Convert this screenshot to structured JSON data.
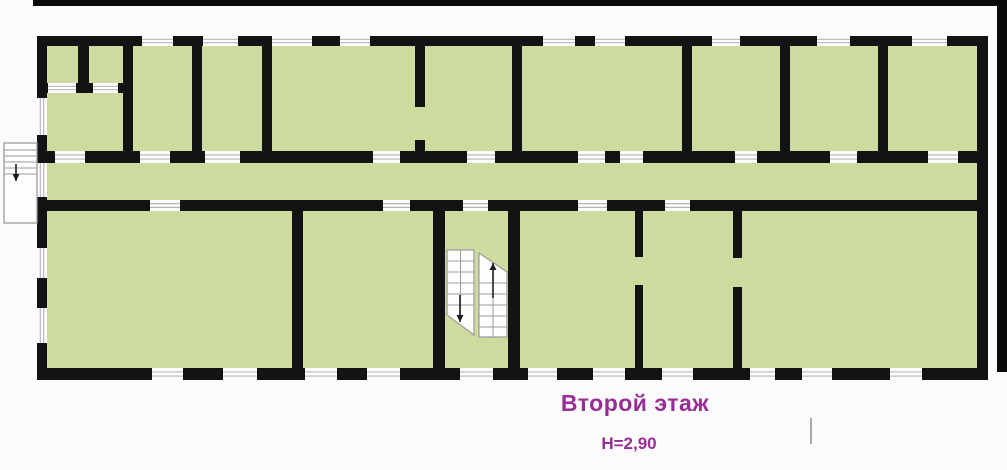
{
  "labels": {
    "floor": "Второй этаж",
    "height": "H=2,90"
  },
  "colors": {
    "page_bg": "#fbfbfb",
    "room_fill": "#cedb9e",
    "wall": "#131313",
    "opening_fill": "#fdfdfd",
    "opening_line": "#b6b6b6",
    "stair_fill": "#fdfdfd",
    "stair_line": "#9b9b9b",
    "arrow": "#1c1c1c",
    "label_text": "#962e96",
    "frame_bar": "#0a0a0a",
    "tick": "#a9a9a9"
  },
  "plan": {
    "canvas": {
      "w": 1007,
      "h": 470
    },
    "building": {
      "x": 37,
      "y": 36,
      "w": 951,
      "h": 344
    },
    "walls": [
      {
        "x": 37,
        "y": 36,
        "w": 951,
        "h": 10
      },
      {
        "x": 37,
        "y": 151,
        "w": 951,
        "h": 12
      },
      {
        "x": 37,
        "y": 200,
        "w": 951,
        "h": 11
      },
      {
        "x": 37,
        "y": 368,
        "w": 951,
        "h": 12
      },
      {
        "x": 37,
        "y": 36,
        "w": 10,
        "h": 344
      },
      {
        "x": 977,
        "y": 36,
        "w": 11,
        "h": 344
      },
      {
        "x": 37,
        "y": 83,
        "w": 96,
        "h": 10
      },
      {
        "x": 78,
        "y": 36,
        "w": 11,
        "h": 57
      },
      {
        "x": 123,
        "y": 36,
        "w": 10,
        "h": 127
      },
      {
        "x": 192,
        "y": 36,
        "w": 10,
        "h": 127
      },
      {
        "x": 262,
        "y": 36,
        "w": 10,
        "h": 127
      },
      {
        "x": 415,
        "y": 36,
        "w": 10,
        "h": 71
      },
      {
        "x": 415,
        "y": 140,
        "w": 10,
        "h": 23
      },
      {
        "x": 512,
        "y": 36,
        "w": 10,
        "h": 127
      },
      {
        "x": 682,
        "y": 36,
        "w": 10,
        "h": 127
      },
      {
        "x": 780,
        "y": 36,
        "w": 10,
        "h": 127
      },
      {
        "x": 878,
        "y": 36,
        "w": 10,
        "h": 127
      },
      {
        "x": 292,
        "y": 200,
        "w": 11,
        "h": 180
      },
      {
        "x": 433,
        "y": 200,
        "w": 12,
        "h": 180
      },
      {
        "x": 508,
        "y": 200,
        "w": 12,
        "h": 180
      },
      {
        "x": 635,
        "y": 200,
        "w": 8,
        "h": 57
      },
      {
        "x": 635,
        "y": 285,
        "w": 8,
        "h": 95
      },
      {
        "x": 733,
        "y": 200,
        "w": 9,
        "h": 58
      },
      {
        "x": 733,
        "y": 287,
        "w": 9,
        "h": 93
      }
    ],
    "openings": [
      {
        "x": 142,
        "y": 36,
        "w": 31,
        "h": 10,
        "dir": "h",
        "kind": "window"
      },
      {
        "x": 203,
        "y": 36,
        "w": 35,
        "h": 10,
        "dir": "h",
        "kind": "window"
      },
      {
        "x": 272,
        "y": 36,
        "w": 40,
        "h": 10,
        "dir": "h",
        "kind": "window"
      },
      {
        "x": 340,
        "y": 36,
        "w": 30,
        "h": 10,
        "dir": "h",
        "kind": "window"
      },
      {
        "x": 543,
        "y": 36,
        "w": 32,
        "h": 10,
        "dir": "h",
        "kind": "window"
      },
      {
        "x": 595,
        "y": 36,
        "w": 30,
        "h": 10,
        "dir": "h",
        "kind": "window"
      },
      {
        "x": 712,
        "y": 36,
        "w": 28,
        "h": 10,
        "dir": "h",
        "kind": "window"
      },
      {
        "x": 817,
        "y": 36,
        "w": 33,
        "h": 10,
        "dir": "h",
        "kind": "window"
      },
      {
        "x": 912,
        "y": 36,
        "w": 35,
        "h": 10,
        "dir": "h",
        "kind": "window"
      },
      {
        "x": 55,
        "y": 151,
        "w": 30,
        "h": 12,
        "dir": "h",
        "kind": "door"
      },
      {
        "x": 140,
        "y": 151,
        "w": 30,
        "h": 12,
        "dir": "h",
        "kind": "door"
      },
      {
        "x": 205,
        "y": 151,
        "w": 35,
        "h": 12,
        "dir": "h",
        "kind": "door"
      },
      {
        "x": 373,
        "y": 151,
        "w": 27,
        "h": 12,
        "dir": "h",
        "kind": "door"
      },
      {
        "x": 467,
        "y": 151,
        "w": 28,
        "h": 12,
        "dir": "h",
        "kind": "door"
      },
      {
        "x": 578,
        "y": 151,
        "w": 27,
        "h": 12,
        "dir": "h",
        "kind": "door"
      },
      {
        "x": 620,
        "y": 151,
        "w": 23,
        "h": 12,
        "dir": "h",
        "kind": "door"
      },
      {
        "x": 735,
        "y": 151,
        "w": 22,
        "h": 12,
        "dir": "h",
        "kind": "door"
      },
      {
        "x": 830,
        "y": 151,
        "w": 27,
        "h": 12,
        "dir": "h",
        "kind": "door"
      },
      {
        "x": 928,
        "y": 151,
        "w": 30,
        "h": 12,
        "dir": "h",
        "kind": "door"
      },
      {
        "x": 150,
        "y": 200,
        "w": 30,
        "h": 11,
        "dir": "h",
        "kind": "door"
      },
      {
        "x": 383,
        "y": 200,
        "w": 27,
        "h": 11,
        "dir": "h",
        "kind": "door"
      },
      {
        "x": 463,
        "y": 200,
        "w": 25,
        "h": 11,
        "dir": "h",
        "kind": "door"
      },
      {
        "x": 578,
        "y": 200,
        "w": 29,
        "h": 11,
        "dir": "h",
        "kind": "door"
      },
      {
        "x": 665,
        "y": 200,
        "w": 25,
        "h": 11,
        "dir": "h",
        "kind": "door"
      },
      {
        "x": 152,
        "y": 368,
        "w": 31,
        "h": 12,
        "dir": "h",
        "kind": "window"
      },
      {
        "x": 223,
        "y": 368,
        "w": 34,
        "h": 12,
        "dir": "h",
        "kind": "window"
      },
      {
        "x": 305,
        "y": 368,
        "w": 32,
        "h": 12,
        "dir": "h",
        "kind": "window"
      },
      {
        "x": 367,
        "y": 368,
        "w": 33,
        "h": 12,
        "dir": "h",
        "kind": "window"
      },
      {
        "x": 460,
        "y": 368,
        "w": 33,
        "h": 12,
        "dir": "h",
        "kind": "window"
      },
      {
        "x": 528,
        "y": 368,
        "w": 29,
        "h": 12,
        "dir": "h",
        "kind": "window"
      },
      {
        "x": 593,
        "y": 368,
        "w": 32,
        "h": 12,
        "dir": "h",
        "kind": "window"
      },
      {
        "x": 662,
        "y": 368,
        "w": 31,
        "h": 12,
        "dir": "h",
        "kind": "window"
      },
      {
        "x": 750,
        "y": 368,
        "w": 25,
        "h": 12,
        "dir": "h",
        "kind": "window"
      },
      {
        "x": 802,
        "y": 368,
        "w": 30,
        "h": 12,
        "dir": "h",
        "kind": "window"
      },
      {
        "x": 890,
        "y": 368,
        "w": 32,
        "h": 12,
        "dir": "h",
        "kind": "window"
      },
      {
        "x": 37,
        "y": 98,
        "w": 10,
        "h": 37,
        "dir": "v",
        "kind": "window"
      },
      {
        "x": 37,
        "y": 163,
        "w": 10,
        "h": 34,
        "dir": "v",
        "kind": "door"
      },
      {
        "x": 37,
        "y": 248,
        "w": 10,
        "h": 30,
        "dir": "v",
        "kind": "window"
      },
      {
        "x": 37,
        "y": 308,
        "w": 10,
        "h": 35,
        "dir": "v",
        "kind": "window"
      },
      {
        "x": 48,
        "y": 83,
        "w": 28,
        "h": 10,
        "dir": "h",
        "kind": "door"
      },
      {
        "x": 93,
        "y": 83,
        "w": 25,
        "h": 10,
        "dir": "h",
        "kind": "door"
      }
    ],
    "exterior_stair": {
      "box": [
        4,
        143,
        33,
        80
      ],
      "treads_y": [
        150,
        156,
        162,
        168,
        174
      ],
      "arrow": {
        "x": 16,
        "y1": 164,
        "y2": 181,
        "dir": "down"
      }
    },
    "stair_flights": [
      {
        "points": "447,250 474,250 474,335 447,315",
        "tx": [
          447,
          474
        ],
        "treads_y": [
          261,
          272,
          283,
          294,
          305
        ],
        "mid_x": 460.5,
        "mid_y": [
          250,
          315
        ],
        "arrow": {
          "x": 460,
          "y1": 295,
          "y2": 322,
          "dir": "down"
        }
      },
      {
        "points": "479,253 507,272 507,337 479,337",
        "tx": [
          479,
          507
        ],
        "treads_y": [
          283,
          294,
          305,
          316,
          327
        ],
        "mid_x": 493,
        "mid_y": [
          272,
          337
        ],
        "arrow": {
          "x": 493,
          "y1": 298,
          "y2": 263,
          "dir": "up"
        }
      }
    ],
    "frame": {
      "top_bar": {
        "x": 33,
        "y": 0,
        "w": 974,
        "h": 6
      },
      "right_bar": {
        "x": 997,
        "y": 0,
        "w": 10,
        "h": 372
      },
      "tick": {
        "x": 810,
        "y": 418,
        "w": 2,
        "h": 26
      }
    }
  }
}
